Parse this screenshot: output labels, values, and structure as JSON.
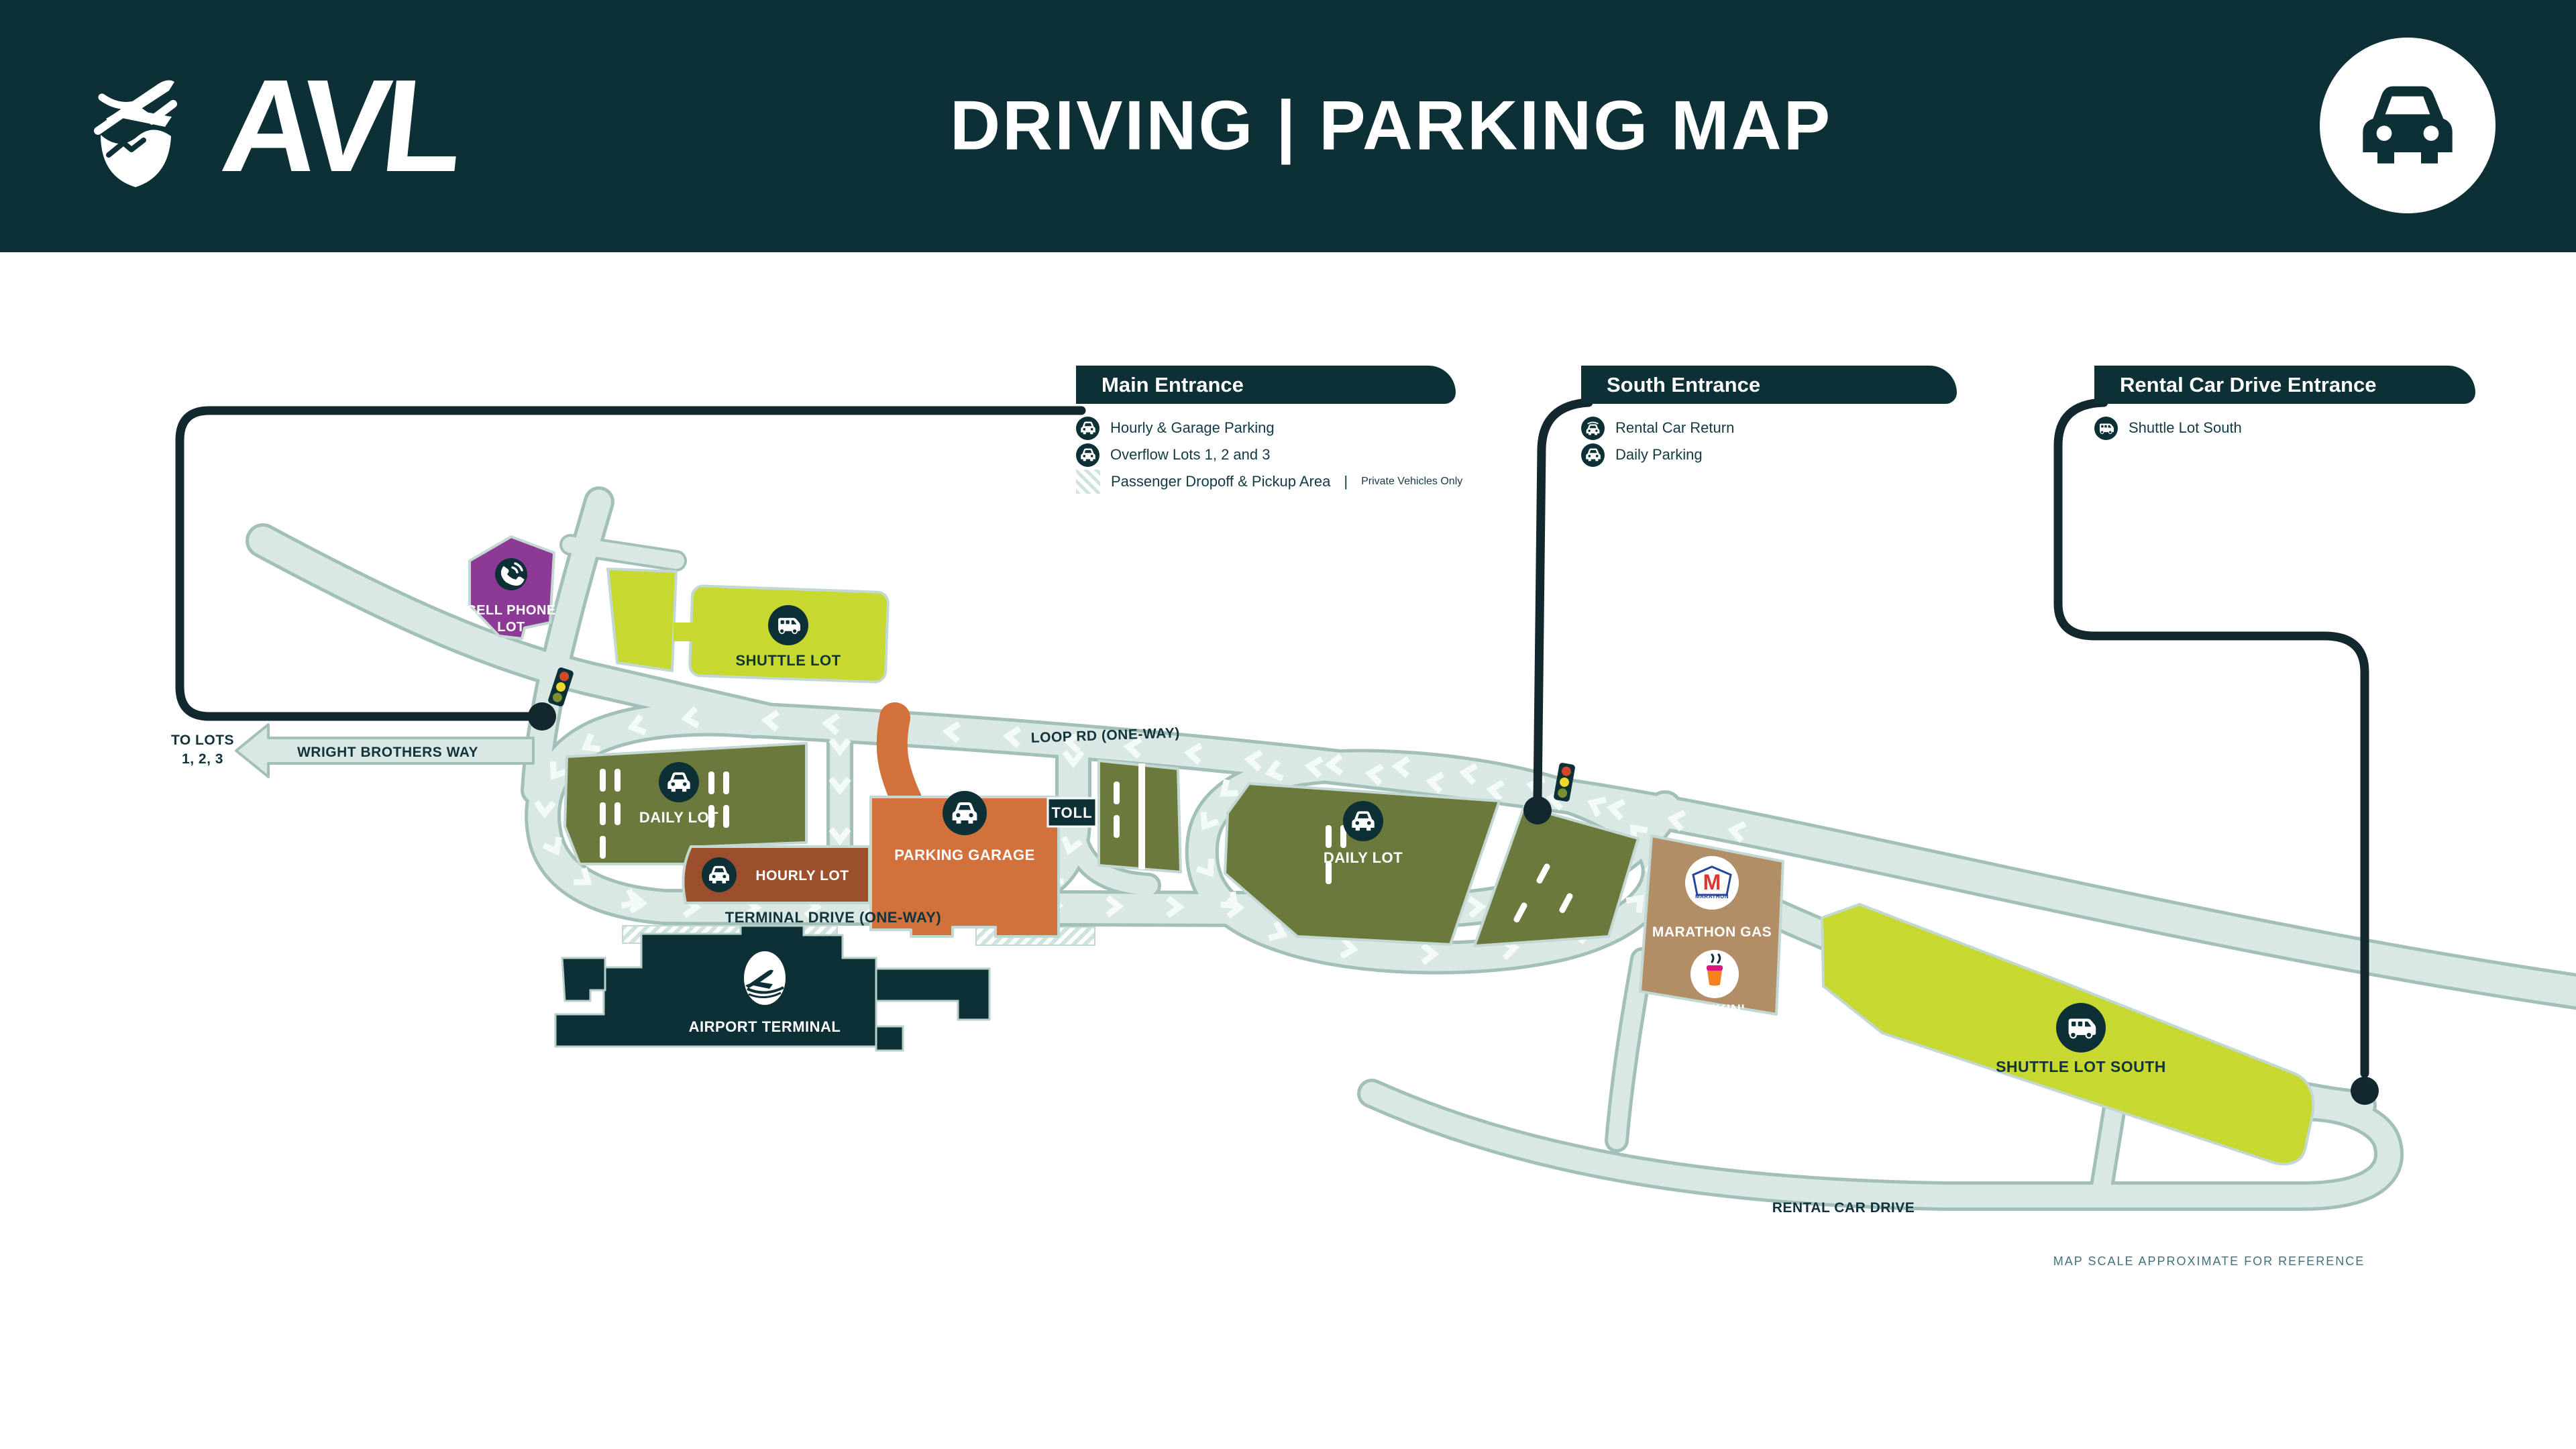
{
  "header": {
    "logo_text": "AVL",
    "title": "DRIVING | PARKING MAP"
  },
  "legend": {
    "main_entrance": {
      "title": "Main Entrance",
      "items": [
        {
          "icon": "car-icon",
          "label": "Hourly & Garage Parking"
        },
        {
          "icon": "car-icon",
          "label": "Overflow Lots 1, 2 and 3"
        },
        {
          "icon": "stripes-swatch",
          "label": "Passenger Dropoff & Pickup Area",
          "separator": "|",
          "note": "Private Vehicles Only"
        }
      ]
    },
    "south_entrance": {
      "title": "South Entrance",
      "items": [
        {
          "icon": "shuttle-icon",
          "label": "Rental Car Return"
        },
        {
          "icon": "car-icon",
          "label": "Daily Parking"
        }
      ]
    },
    "rental_entrance": {
      "title": "Rental Car Drive Entrance",
      "items": [
        {
          "icon": "shuttle-icon",
          "label": "Shuttle Lot South"
        }
      ]
    }
  },
  "map": {
    "roads": {
      "loop_rd": "LOOP RD (ONE-WAY)",
      "terminal_drive": "TERMINAL DRIVE (ONE-WAY)",
      "wright_brothers": "WRIGHT BROTHERS WAY",
      "rental_car_drive": "RENTAL CAR DRIVE",
      "to_lots_line1": "TO LOTS",
      "to_lots_line2": "1, 2, 3",
      "toll": "TOLL"
    },
    "lots": {
      "cell_phone_line1": "CELL PHONE",
      "cell_phone_line2": "LOT",
      "shuttle_lot": "SHUTTLE LOT",
      "daily_lot_west": "DAILY LOT",
      "hourly_lot": "HOURLY LOT",
      "parking_garage": "PARKING GARAGE",
      "daily_lot_east": "DAILY LOT",
      "shuttle_lot_south": "SHUTTLE LOT SOUTH",
      "airport_terminal": "AIRPORT TERMINAL"
    },
    "pois": {
      "marathon": "MARATHON GAS",
      "marathon_logo_letter": "M",
      "marathon_wordmark": "MARATHON",
      "dunkin": "DUNKIN'"
    },
    "notes": {
      "scale": "MAP SCALE APPROXIMATE FOR REFERENCE"
    },
    "colors": {
      "brand_dark": "#0D2F36",
      "road_fill": "#D9E8E5",
      "road_edge": "#A3BFBA",
      "olive": "#6B7A3C",
      "yellow_green": "#C7D931",
      "purple": "#8C3A95",
      "rust": "#9B4F2C",
      "orange": "#D2713C",
      "tan": "#B28E66",
      "route_line": "#13282E",
      "scale_note": "#41707E",
      "signal_red": "#D2492A",
      "signal_yellow": "#F0D72C",
      "signal_green": "#7E8F33",
      "marathon_red": "#D8392C",
      "marathon_blue": "#27459C",
      "dunkin_orange": "#F5821F",
      "dunkin_pink": "#E11383"
    }
  }
}
